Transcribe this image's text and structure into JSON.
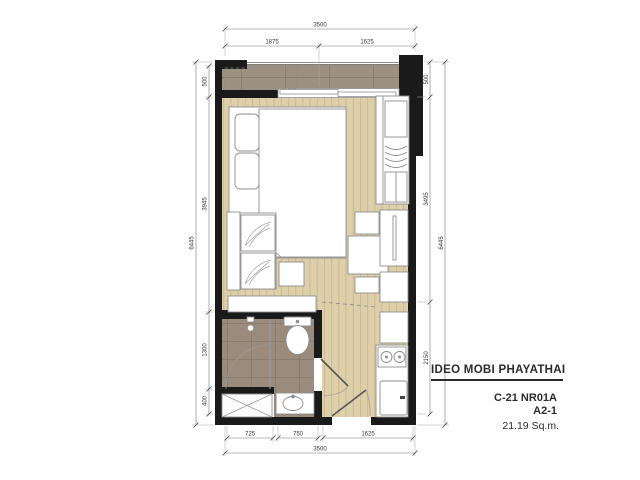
{
  "document": {
    "project": "IDEO MOBI PHAYATHAI",
    "unit_code": "C-21 NR01A",
    "unit_type": "A2-1",
    "unit_area": "21.19 Sq.m."
  },
  "dimensions": {
    "top": {
      "overall": "3500",
      "segments": [
        "1875",
        "1625"
      ]
    },
    "bottom": {
      "overall": "3500",
      "segments": [
        "725",
        "750",
        "1625"
      ]
    },
    "left": {
      "overall": "6445",
      "segments": [
        "500",
        "3945",
        "1300",
        "400"
      ]
    },
    "right": {
      "overall": "6445",
      "segments": [
        "500",
        "3495",
        "2150"
      ]
    }
  },
  "colors": {
    "wall": "#1a1a1a",
    "wood_floor": "#ddcfa9",
    "wood_line": "#c7b58c",
    "balcony_tile": "#9c9081",
    "bathroom_tile": "#9a8b7d",
    "tile_line": "#857869",
    "furniture_fill": "#ffffff",
    "furniture_stroke": "#8e8e8e",
    "dimension_line": "#787878",
    "text": "#2b2b2b"
  }
}
